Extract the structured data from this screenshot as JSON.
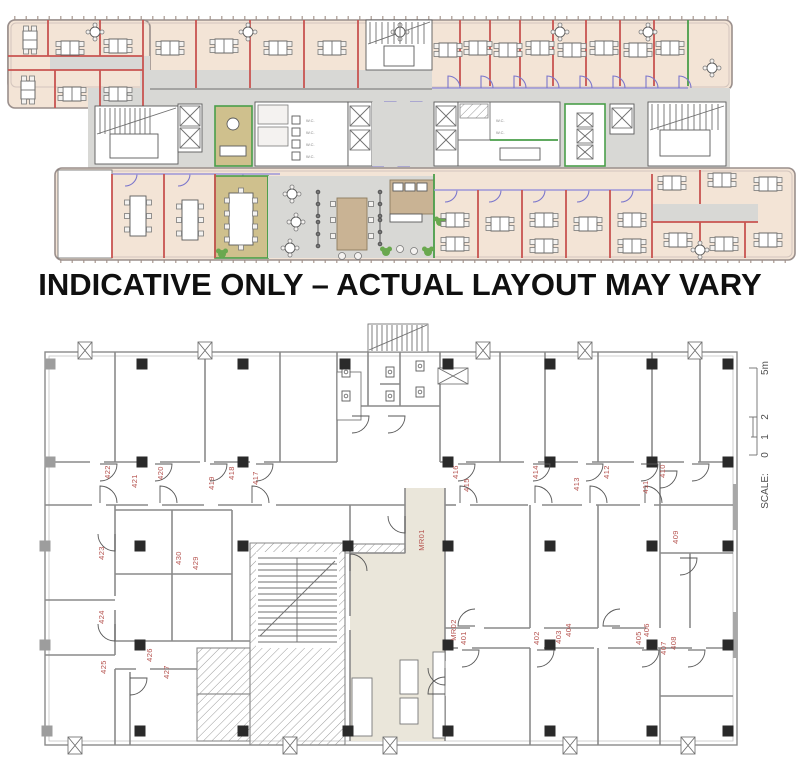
{
  "banner": {
    "text": "INDICATIVE ONLY – ACTUAL LAYOUT MAY VARY"
  },
  "upper_plan": {
    "description": "Indicative furnished office floor plan",
    "colors": {
      "room_fill": "#f3e4d6",
      "meeting_room_fill": "#cfc08d",
      "corridor_fill": "#d8d8d5",
      "partition_red": "#c85450",
      "partition_purple": "#9c95d8",
      "partition_green": "#4a9e4a"
    },
    "wc_labels": [
      {
        "text": "W.C.",
        "x": 306,
        "y": 114
      },
      {
        "text": "W.C.",
        "x": 306,
        "y": 126
      },
      {
        "text": "W.C.",
        "x": 306,
        "y": 138
      },
      {
        "text": "W.C.",
        "x": 306,
        "y": 150
      },
      {
        "text": "W.C.",
        "x": 496,
        "y": 114
      },
      {
        "text": "W.C.",
        "x": 496,
        "y": 126
      }
    ]
  },
  "lower_plan": {
    "description": "Architectural floor plan with numbered rooms",
    "label_color": "#b5524e",
    "room_labels": [
      {
        "text": "422",
        "x": 110,
        "y": 156
      },
      {
        "text": "421",
        "x": 137,
        "y": 165
      },
      {
        "text": "420",
        "x": 163,
        "y": 157
      },
      {
        "text": "419",
        "x": 214,
        "y": 167
      },
      {
        "text": "418",
        "x": 234,
        "y": 157
      },
      {
        "text": "417",
        "x": 258,
        "y": 162
      },
      {
        "text": "416",
        "x": 458,
        "y": 156
      },
      {
        "text": "415",
        "x": 469,
        "y": 169
      },
      {
        "text": "414",
        "x": 538,
        "y": 156
      },
      {
        "text": "413",
        "x": 579,
        "y": 168
      },
      {
        "text": "412",
        "x": 609,
        "y": 156
      },
      {
        "text": "411",
        "x": 648,
        "y": 171
      },
      {
        "text": "410",
        "x": 665,
        "y": 155
      },
      {
        "text": "409",
        "x": 678,
        "y": 221
      },
      {
        "text": "MR01",
        "x": 424,
        "y": 224
      },
      {
        "text": "423",
        "x": 104,
        "y": 237
      },
      {
        "text": "430",
        "x": 181,
        "y": 242
      },
      {
        "text": "429",
        "x": 198,
        "y": 247
      },
      {
        "text": "424",
        "x": 104,
        "y": 301
      },
      {
        "text": "425",
        "x": 106,
        "y": 351
      },
      {
        "text": "426",
        "x": 152,
        "y": 339
      },
      {
        "text": "427",
        "x": 169,
        "y": 356
      },
      {
        "text": "MR02",
        "x": 456,
        "y": 314
      },
      {
        "text": "401",
        "x": 466,
        "y": 322
      },
      {
        "text": "402",
        "x": 539,
        "y": 322
      },
      {
        "text": "403",
        "x": 561,
        "y": 321
      },
      {
        "text": "404",
        "x": 571,
        "y": 314
      },
      {
        "text": "405",
        "x": 641,
        "y": 322
      },
      {
        "text": "406",
        "x": 649,
        "y": 314
      },
      {
        "text": "407",
        "x": 666,
        "y": 332
      },
      {
        "text": "408",
        "x": 676,
        "y": 327
      }
    ],
    "scale_bar": {
      "label": "SCALE:",
      "label_x": 768,
      "label_y": 175,
      "ticks": [
        {
          "text": "0",
          "y": 139
        },
        {
          "text": "1",
          "y": 121
        },
        {
          "text": "2",
          "y": 101
        },
        {
          "text": "5m",
          "y": 52
        }
      ]
    }
  }
}
